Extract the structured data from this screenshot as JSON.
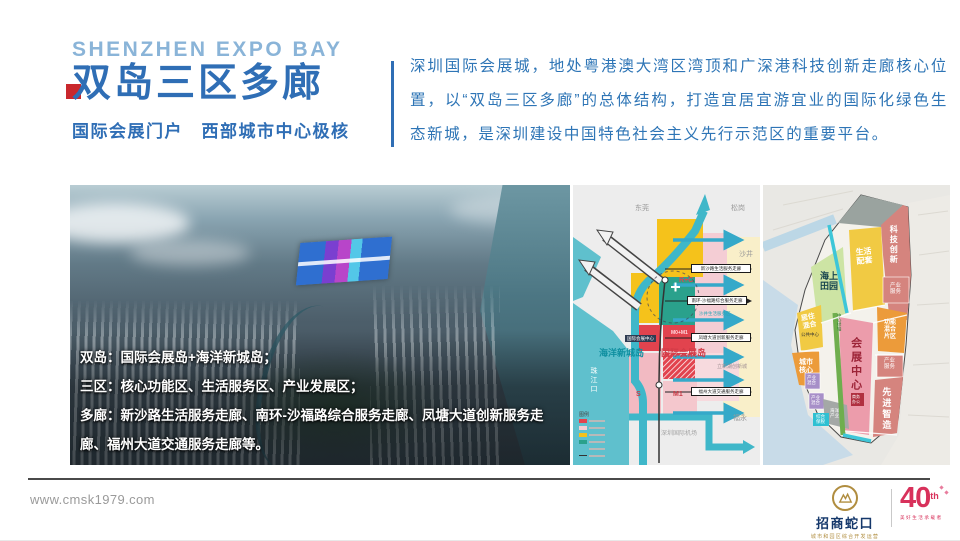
{
  "colors": {
    "primary_blue": "#2f6eb5",
    "light_blue": "#8ab4d8",
    "accent_red": "#c9282d",
    "divider_dark": "#4a4a4a",
    "footer_gray": "#9a9a9a",
    "brand_navy": "#15386b",
    "brand_gold": "#b08d3f",
    "anniversary_red": "#d8315b"
  },
  "header": {
    "title_en": "SHENZHEN EXPO BAY",
    "title_cn": "双岛三区多廊",
    "subtitle": "国际会展门户　西部城市中心极核",
    "intro": "深圳国际会展城，地处粤港澳大湾区湾顶和广深港科技创新走廊核心位置，以“双岛三区多廊”的总体结构，打造宜居宜游宜业的国际化绿色生态新城，是深圳建设中国特色社会主义先行示范区的重要平台。"
  },
  "photo_overlay": {
    "items": [
      {
        "label": "双岛：",
        "text": "国际会展岛+海洋新城岛；"
      },
      {
        "label": "三区：",
        "text": "核心功能区、生活服务区、产业发展区；"
      },
      {
        "label": "多廊：",
        "text": "新沙路生活服务走廊、南环-沙福路综合服务走廊、凤塘大道创新服务走廊、福州大道交通服务走廊等。"
      }
    ]
  },
  "map_schematic": {
    "regions": [
      "东莞",
      "松岗",
      "沙井",
      "福永"
    ],
    "water_label": "珠江口",
    "islands": [
      "海洋新城岛",
      "国际会展岛"
    ],
    "center_label": "国际会展中心",
    "airport": "深圳国际机场",
    "district": "立新湖创新城",
    "service_area": "沙井生活服务区",
    "zone_codes": [
      "R+C",
      "M0+M1",
      "M1",
      "S"
    ],
    "corridors": [
      "新沙路生活服务走廊",
      "南环-沙福路综合服务走廊",
      "凤塘大道创新服务走廊",
      "福州大道交通服务走廊"
    ],
    "legend_title": "图例"
  },
  "map_zoning": {
    "zones": {
      "tech": "科技创新",
      "living": "生活配套",
      "sea_garden": "海上田园",
      "residential": "居住混合",
      "city_core": "城市核心",
      "industry_service": "产业服务",
      "mixed_function": "功能混合片区",
      "expo_center": "会展中心",
      "advanced_mfg": "先进智造",
      "industry_mixed": "产业混合",
      "marine_industry": "海洋产业",
      "bonded": "综合保税",
      "business_office": "商务办公",
      "public_center": "公共中心",
      "green_axis": "中心绿轴"
    }
  },
  "footer": {
    "website": "www.cmsk1979.com",
    "brand_name": "招商蛇口",
    "brand_tagline": "城市和园区综合开发运营",
    "anniversary_number": "40",
    "anniversary_suffix": "th",
    "anniversary_tagline": "美好生活承载者"
  }
}
